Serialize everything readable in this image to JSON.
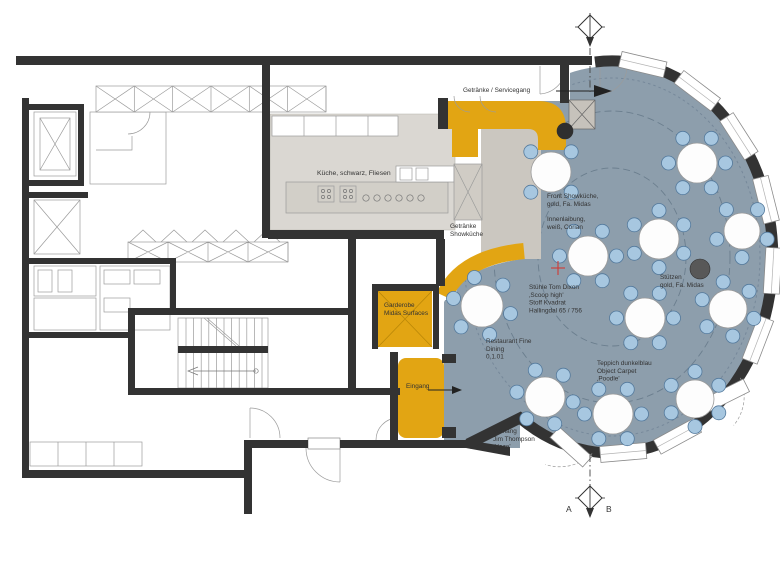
{
  "title": {
    "parts": [
      {
        "text": "FINE DINING***",
        "bold": true
      },
      {
        "text": " RESTAURANT / ",
        "bold": false
      },
      {
        "text": "GRUNDRISS",
        "bold": true
      },
      {
        "text": " / 1:75 /",
        "bold": false
      }
    ]
  },
  "colors": {
    "navy": "#1d2f6f",
    "gold": "#e2a513",
    "carpet": "#8d9eac",
    "chair": "#a7c7e0",
    "wall": "#333333",
    "red_cross": "#cf3b35"
  },
  "labels": [
    {
      "id": "servicegang",
      "x": 463,
      "y": 92,
      "lines": [
        "Getränke / Servicegang"
      ]
    },
    {
      "id": "kueche",
      "x": 317,
      "y": 175,
      "fs": 6.8,
      "lines": [
        "Küche, schwarz, Fliesen"
      ]
    },
    {
      "id": "getraenke-showkueche",
      "x": 450,
      "y": 228,
      "lines": [
        "Getränke",
        "Showküche"
      ]
    },
    {
      "id": "front-showkueche",
      "x": 547,
      "y": 198,
      "lines": [
        "Front Showküche,",
        "gold,  Fa. Midas"
      ]
    },
    {
      "id": "innenlaibung",
      "x": 547,
      "y": 221,
      "lines": [
        "Innenlaibung,",
        "weiß, Corian"
      ]
    },
    {
      "id": "stuehle",
      "x": 529,
      "y": 289,
      "lines": [
        "Stühle Tom Dixon",
        "‚Scoop high'",
        "Stoff Kvadrat",
        "Hallingdal 65 / 756"
      ]
    },
    {
      "id": "stuetzen",
      "x": 660,
      "y": 279,
      "lines": [
        "Stützen",
        "gold, Fa. Midas"
      ]
    },
    {
      "id": "garderobe",
      "x": 384,
      "y": 307,
      "lines": [
        "Garderobe",
        "Midas Surfaces"
      ]
    },
    {
      "id": "restaurant",
      "x": 486,
      "y": 343,
      "lines": [
        "Restaurant Fine",
        "Dining",
        "0.1.01"
      ]
    },
    {
      "id": "teppich",
      "x": 597,
      "y": 365,
      "lines": [
        "Teppich dunkelblau",
        "Object Carpet",
        "‚Poodle'"
      ]
    },
    {
      "id": "eingang",
      "x": 406,
      "y": 388,
      "lines": [
        "Eingang"
      ]
    },
    {
      "id": "vorhang",
      "x": 493,
      "y": 433,
      "lines": [
        "Vorhang",
        "Jim Thompson",
        "‚Haze'"
      ]
    }
  ],
  "plan": {
    "tables": [
      {
        "x": 551,
        "y": 172,
        "r": 20,
        "seats": 4,
        "a0": 45
      },
      {
        "x": 697,
        "y": 163,
        "r": 20,
        "seats": 6,
        "a0": 0
      },
      {
        "x": 659,
        "y": 239,
        "r": 20,
        "seats": 6,
        "a0": 30
      },
      {
        "x": 742,
        "y": 231,
        "r": 18,
        "seats": 5,
        "a0": 90
      },
      {
        "x": 588,
        "y": 256,
        "r": 20,
        "seats": 6,
        "a0": 0
      },
      {
        "x": 482,
        "y": 306,
        "r": 21,
        "seats": 6,
        "a0": 15
      },
      {
        "x": 645,
        "y": 318,
        "r": 20,
        "seats": 6,
        "a0": 0
      },
      {
        "x": 728,
        "y": 309,
        "r": 19,
        "seats": 6,
        "a0": 20
      },
      {
        "x": 545,
        "y": 397,
        "r": 20,
        "seats": 6,
        "a0": 10
      },
      {
        "x": 613,
        "y": 414,
        "r": 20,
        "seats": 6,
        "a0": 0
      },
      {
        "x": 695,
        "y": 399,
        "r": 19,
        "seats": 6,
        "a0": 30
      }
    ],
    "columns": [
      {
        "x": 700,
        "y": 269,
        "r": 10,
        "fill": "#585858"
      },
      {
        "x": 565,
        "y": 131,
        "r": 8,
        "fill": "#2f2f2f"
      }
    ],
    "facade": {
      "windows": [
        -79,
        -58,
        -38,
        -17,
        4,
        25,
        66,
        86
      ],
      "doors": [
        45,
        105
      ]
    },
    "markers": {
      "letters": [
        "A",
        "B"
      ]
    },
    "red_cross": {
      "x": 558,
      "y": 268
    }
  }
}
